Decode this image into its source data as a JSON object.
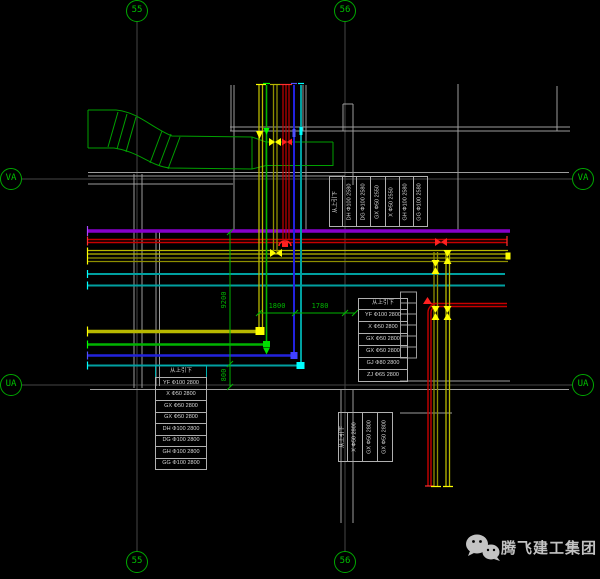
{
  "grid_markers": {
    "col_55": "55",
    "col_56": "56",
    "row_va": "VA",
    "row_ua": "UA"
  },
  "tables": {
    "top": {
      "header": "从上引下",
      "columns": [
        "DH Φ100 2580",
        "DG Φ100 2580",
        "GX Φ50 2550",
        "X Φ50 2550",
        "GH Φ100 2580",
        "GG Φ100 2580"
      ]
    },
    "left": {
      "header": "从上引下",
      "rows": [
        "YF Φ100 2800",
        "X Φ50 2800",
        "GX Φ50 2800",
        "GX Φ50 2800",
        "DH Φ100 2800",
        "DG Φ100 2800",
        "GH Φ100 2800",
        "GG Φ100 2800"
      ]
    },
    "right": {
      "header": "从上引下",
      "rows": [
        "YF Φ100 2800",
        "X Φ50 2800",
        "GX Φ50 2800",
        "GX Φ50 2800",
        "GJ Φ80 2800",
        "ZJ Φ65 2800"
      ]
    },
    "bottom": {
      "header": "从上引下",
      "columns": [
        "X Φ50 2800",
        "GX Φ50 2800",
        "GX Φ50 2800"
      ]
    }
  },
  "dimensions": {
    "vertical_total": "9200",
    "vertical_small": "800",
    "horizontal_1": "1800",
    "horizontal_2": "1780"
  },
  "watermark": {
    "text": "腾飞建工集团"
  },
  "colors": {
    "background": "#000000",
    "grid_green": "#00a800",
    "wall_gray": "#9c9c9c",
    "axis_line": "#464646",
    "duct_green": "#00a000",
    "pipe_purple": "#8800cc",
    "pipe_red": "#c80000",
    "pipe_olive": "#8f8f00",
    "pipe_yellow": "#b8b800",
    "pipe_green": "#00b400",
    "pipe_blue": "#2222dd",
    "pipe_cyan": "#00a0a0",
    "dimension_green": "#00b400",
    "watermark_gray": "#c3c3c3"
  }
}
